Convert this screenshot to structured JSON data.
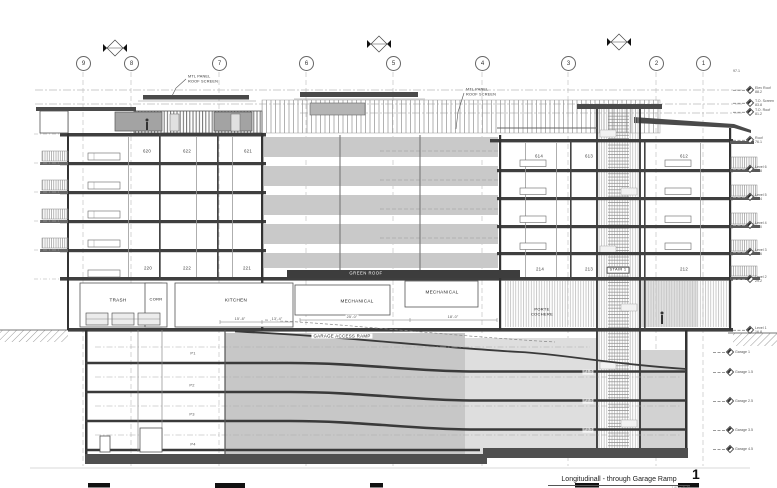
{
  "caption": {
    "title": "Longitudinall - through Garage Ramp",
    "number": "1",
    "scale": "1/8\" = 1'-0\""
  },
  "colors": {
    "ink": "#3a3a3a",
    "slab": "#3f3f3f",
    "band_gray": "#c9c9c9",
    "screen_dark": "#8f8f8f"
  },
  "grids": [
    {
      "n": "9",
      "x": 83
    },
    {
      "n": "8",
      "x": 131
    },
    {
      "n": "7",
      "x": 219
    },
    {
      "n": "6",
      "x": 306
    },
    {
      "n": "5",
      "x": 393
    },
    {
      "n": "4",
      "x": 482
    },
    {
      "n": "3",
      "x": 568
    },
    {
      "n": "2",
      "x": 656
    },
    {
      "n": "1",
      "x": 703
    }
  ],
  "labels": {
    "units": [
      {
        "t": "620",
        "x": 147,
        "y": 151
      },
      {
        "t": "622",
        "x": 187,
        "y": 151
      },
      {
        "t": "621",
        "x": 248,
        "y": 151
      },
      {
        "t": "614",
        "x": 539,
        "y": 156
      },
      {
        "t": "613",
        "x": 589,
        "y": 156
      },
      {
        "t": "612",
        "x": 684,
        "y": 156
      },
      {
        "t": "220",
        "x": 148,
        "y": 268
      },
      {
        "t": "222",
        "x": 187,
        "y": 268
      },
      {
        "t": "221",
        "x": 247,
        "y": 268
      },
      {
        "t": "214",
        "x": 540,
        "y": 269
      },
      {
        "t": "213",
        "x": 589,
        "y": 269
      },
      {
        "t": "212",
        "x": 684,
        "y": 269
      }
    ],
    "rooms": [
      {
        "t": "TRASH",
        "x": 118,
        "y": 300
      },
      {
        "t": "CORR",
        "x": 156,
        "y": 300,
        "cls": "small-l"
      },
      {
        "t": "KITCHEN",
        "x": 236,
        "y": 300
      },
      {
        "t": "MECHANICAL",
        "x": 357,
        "y": 301
      },
      {
        "t": "MECHANICAL",
        "x": 442,
        "y": 292
      },
      {
        "t": "PORTE\nCOCHERE",
        "x": 542,
        "y": 312,
        "cls": "small-l"
      },
      {
        "t": "GARAGE ACCESS RAMP",
        "x": 342,
        "y": 336,
        "cls": "wbg"
      },
      {
        "t": "GREEN ROOF",
        "x": 366,
        "y": 274,
        "cls": "inv"
      },
      {
        "t": "STAIR 1",
        "x": 618,
        "y": 270,
        "cls": "boxed"
      }
    ],
    "garage_levels": [
      {
        "t": "P1",
        "x": 193,
        "y": 354
      },
      {
        "t": "P2",
        "x": 192,
        "y": 386
      },
      {
        "t": "P3",
        "x": 192,
        "y": 415
      },
      {
        "t": "P4",
        "x": 193,
        "y": 445
      },
      {
        "t": "P1.5",
        "x": 588,
        "y": 372
      },
      {
        "t": "P2.5",
        "x": 588,
        "y": 401
      },
      {
        "t": "P3.5",
        "x": 588,
        "y": 430
      }
    ],
    "dims": [
      {
        "t": "15'-8\"",
        "x": 240,
        "y": 319
      },
      {
        "t": "13'-4\"",
        "x": 277,
        "y": 319
      },
      {
        "t": "25'-0\"",
        "x": 352,
        "y": 317
      },
      {
        "t": "18'-0\"",
        "x": 453,
        "y": 317
      }
    ],
    "annotations": [
      {
        "t": "MTL PANEL\nROOF SCREEN",
        "x": 188,
        "y": 79,
        "cls": "ann"
      },
      {
        "t": "MTL PANEL\nROOF SCREEN",
        "x": 466,
        "y": 92,
        "cls": "ann"
      }
    ]
  },
  "elevations": {
    "right": [
      {
        "t": "97.1",
        "y": 71,
        "flag": false
      },
      {
        "t": "Elev Roof",
        "e": "88.2",
        "y": 90
      },
      {
        "t": "T.O. Screen",
        "e": "83.8",
        "y": 103
      },
      {
        "t": "T.O. Roof",
        "e": "81.2",
        "y": 112
      },
      {
        "t": "Roof",
        "e": "76.1",
        "y": 140
      },
      {
        "t": "Level 6",
        "e": "66.8",
        "y": 169
      },
      {
        "t": "Level 5",
        "e": "57.4",
        "y": 197
      },
      {
        "t": "Level 4",
        "e": "48.0",
        "y": 225
      },
      {
        "t": "Level 3",
        "e": "38.6",
        "y": 252
      },
      {
        "t": "Level 2",
        "e": "29.2",
        "y": 279
      },
      {
        "t": "Level 1",
        "e": "16.8",
        "y": 330
      }
    ],
    "below": [
      {
        "t": "Garage 1",
        "y": 352
      },
      {
        "t": "Garage 1.5",
        "y": 372
      },
      {
        "t": "Garage 2.5",
        "y": 401
      },
      {
        "t": "Garage 3.5",
        "y": 430
      },
      {
        "t": "Garage 4.5",
        "y": 449
      }
    ]
  }
}
